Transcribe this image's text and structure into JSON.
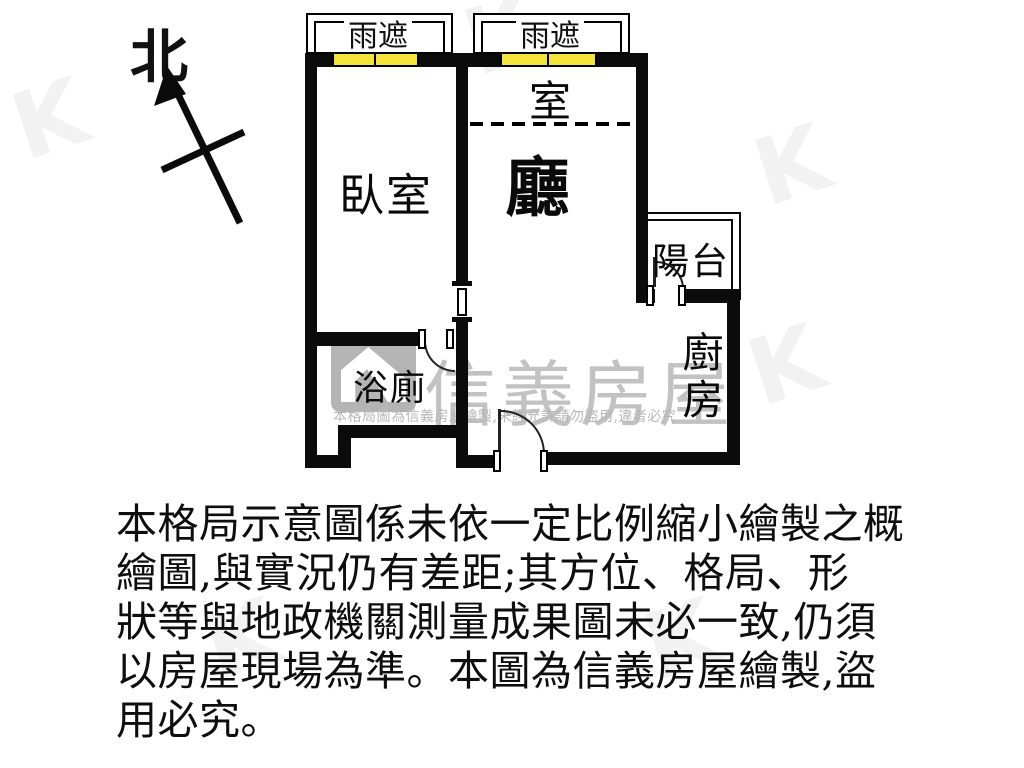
{
  "compass": {
    "north_label": "北"
  },
  "plan": {
    "labels": {
      "canopy_left": "雨遮",
      "canopy_right": "雨遮",
      "room_upper": "室",
      "living": "廳",
      "bedroom": "臥室",
      "balcony": "陽台",
      "bathroom": "浴廁",
      "kitchen": "廚房"
    },
    "window_color": "#f2e438",
    "wall_color": "#0b0b0b"
  },
  "watermark": {
    "brand": "信義房屋",
    "notice": "本格局圖為信義房屋繪製,未經允許請勿盜用,違者必究"
  },
  "disclaimer": {
    "lines": [
      "本格局示意圖係未依一定比例縮小繪製之概",
      "繪圖,與實況仍有差距;其方位、格局、形",
      "狀等與地政機關測量成果圖未必一致,仍須",
      "以房屋現場為準。本圖為信義房屋繪製,盜",
      "用必究。"
    ]
  }
}
